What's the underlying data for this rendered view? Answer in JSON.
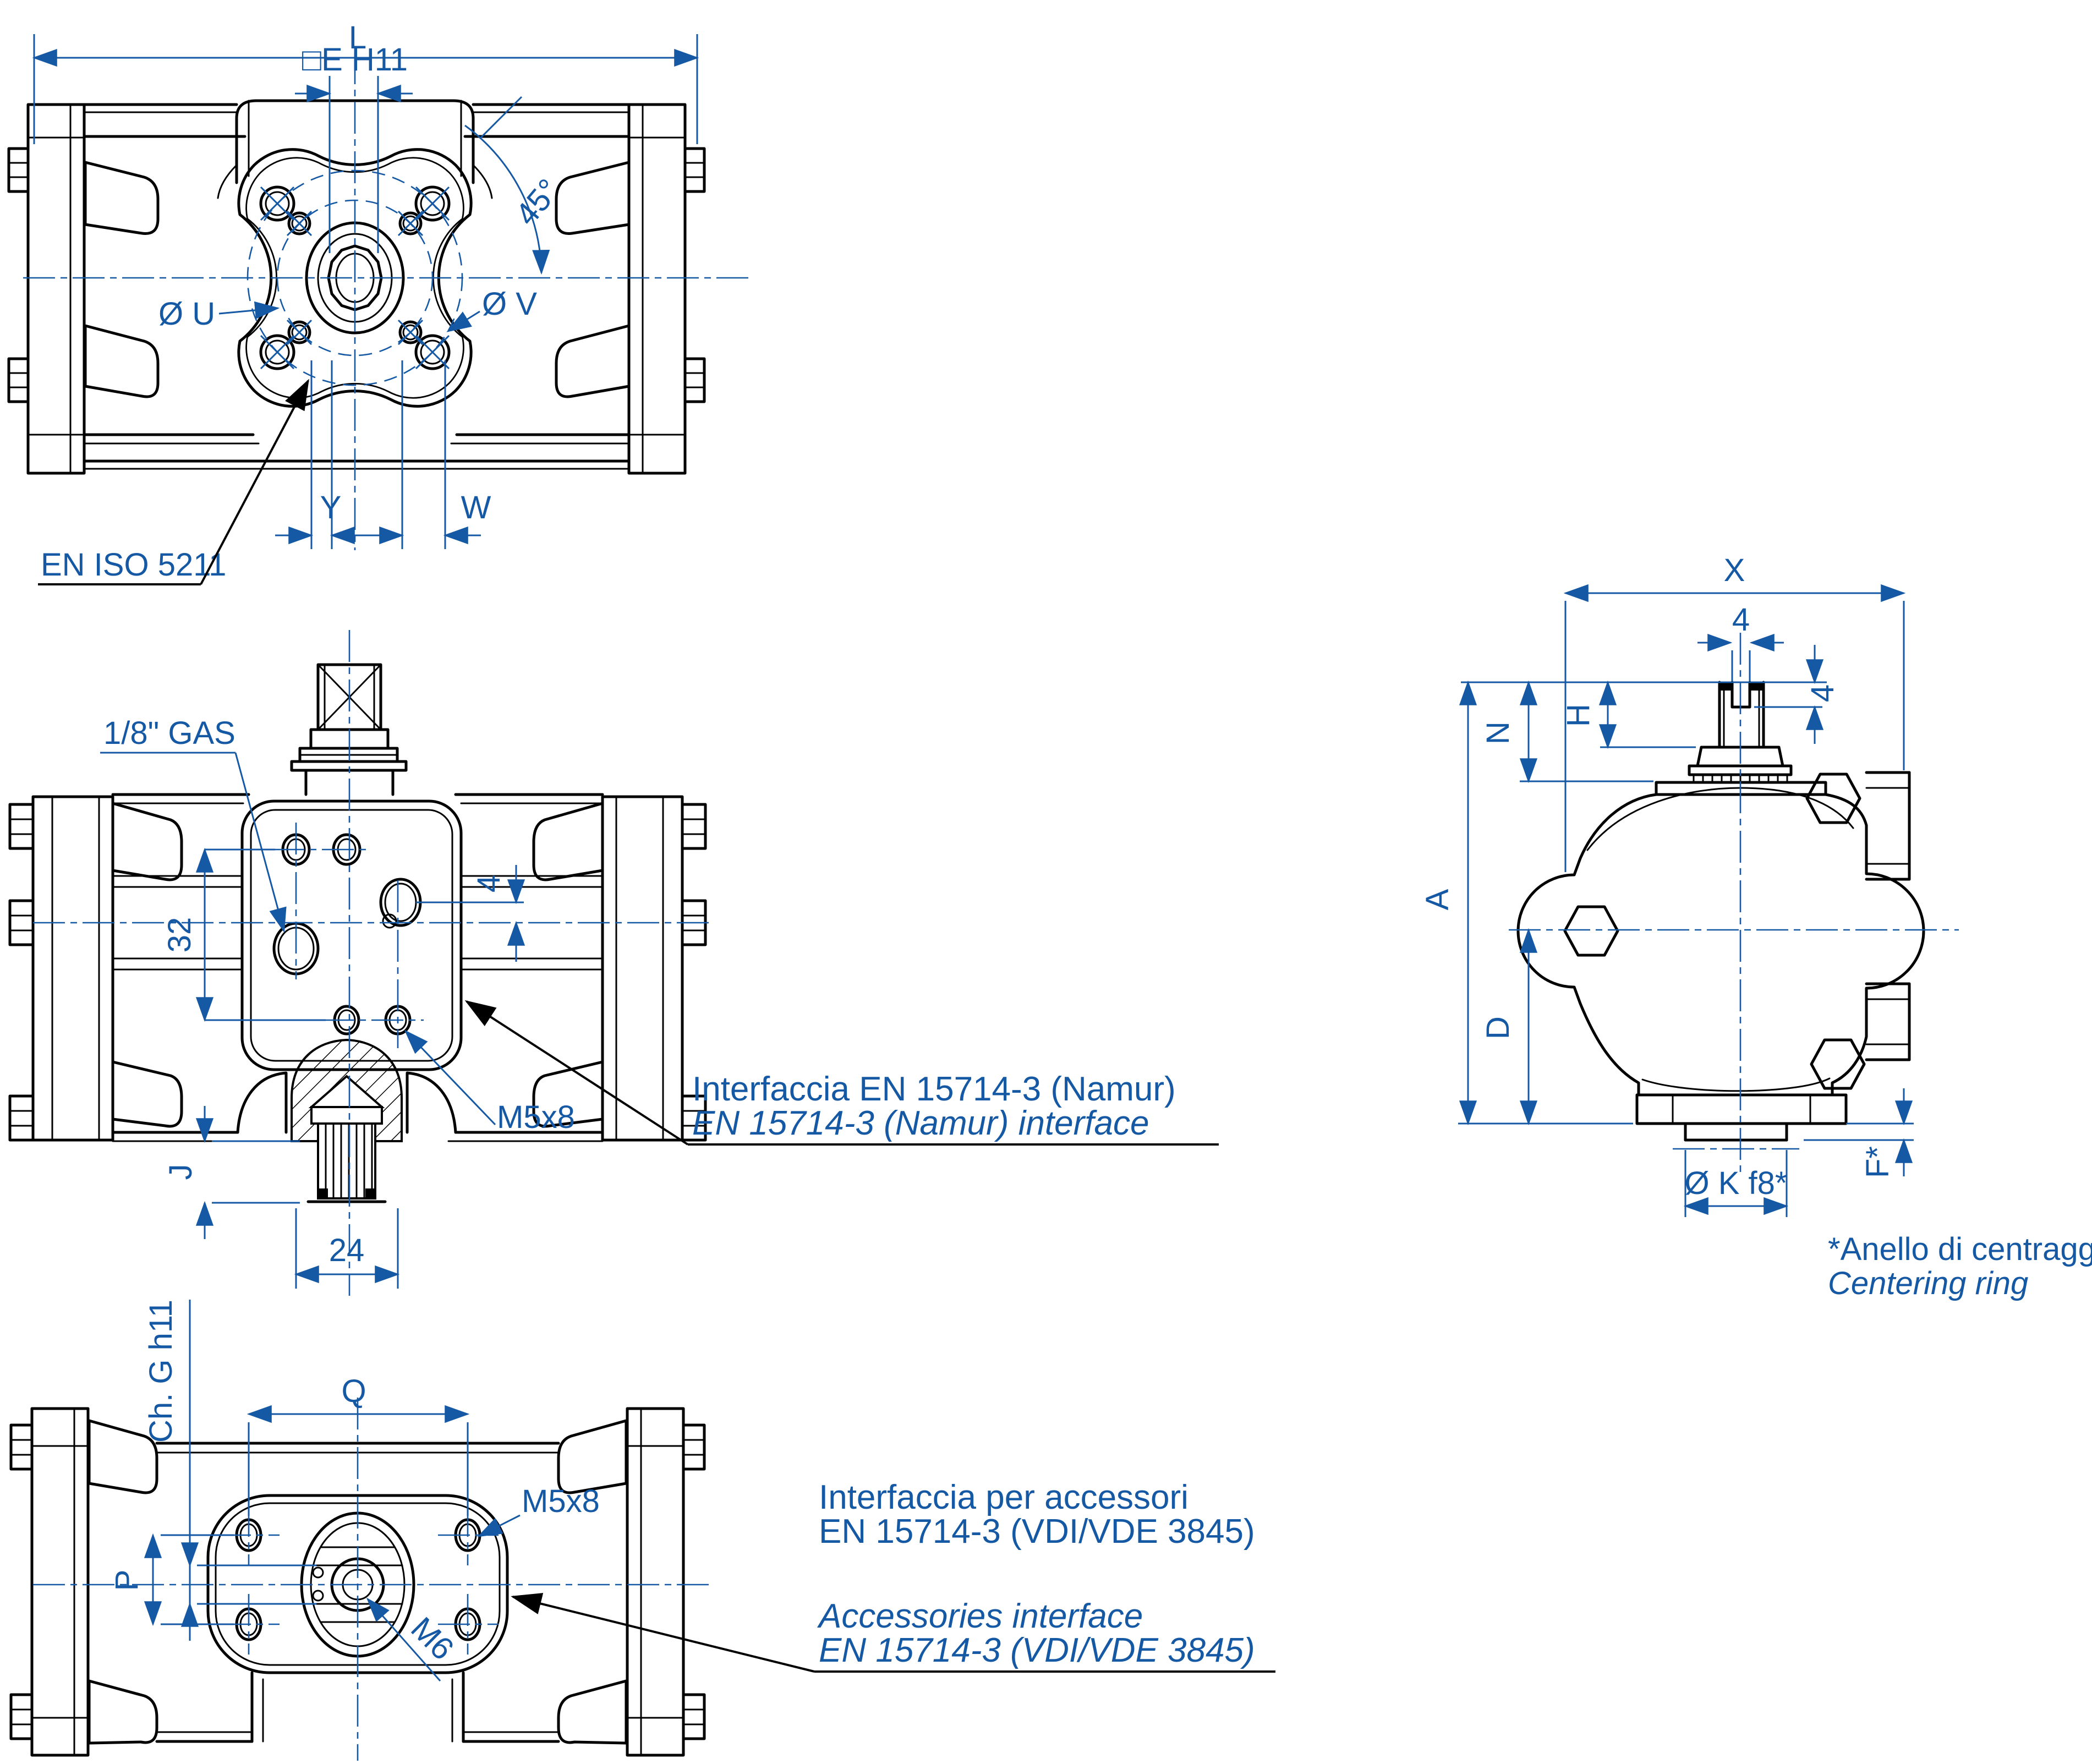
{
  "drawing": {
    "colors": {
      "line": "#000000",
      "dimension": "#1558A4"
    },
    "front_view": {
      "dim_length": "L",
      "dim_square_bore": "□E H11",
      "dim_angle": "45°",
      "dim_bolt_circle_u": "Ø U",
      "dim_bolt_circle_v": "Ø V",
      "dim_y": "Y",
      "dim_w": "W",
      "flange_standard": "EN ISO 5211"
    },
    "top_view": {
      "air_port": "1/8\" GAS",
      "dim_32": "32",
      "dim_4": "4",
      "dim_j": "J",
      "dim_24": "24",
      "thread_m5": "M5x8",
      "note_it": "Interfaccia EN 15714-3 (Namur)",
      "note_en": "EN 15714-3 (Namur) interface"
    },
    "side_view": {
      "dim_x": "X",
      "dim_slot_width": "4",
      "dim_slot_depth": "4",
      "dim_n": "N",
      "dim_h": "H",
      "dim_a": "A",
      "dim_d": "D",
      "dim_k": "Ø K f8*",
      "dim_f": "F*",
      "footnote_it": "*Anello di centraggio",
      "footnote_en": "Centering ring"
    },
    "bottom_view": {
      "dim_chamfer": "Ch. G h11",
      "dim_q": "Q",
      "thread_m5": "M5x8",
      "dim_p": "P",
      "thread_m6": "M6",
      "note_it_line1": "Interfaccia per accessori",
      "note_it_line2": "EN 15714-3 (VDI/VDE 3845)",
      "note_en_line1": "Accessories interface",
      "note_en_line2": "EN 15714-3 (VDI/VDE 3845)"
    }
  }
}
